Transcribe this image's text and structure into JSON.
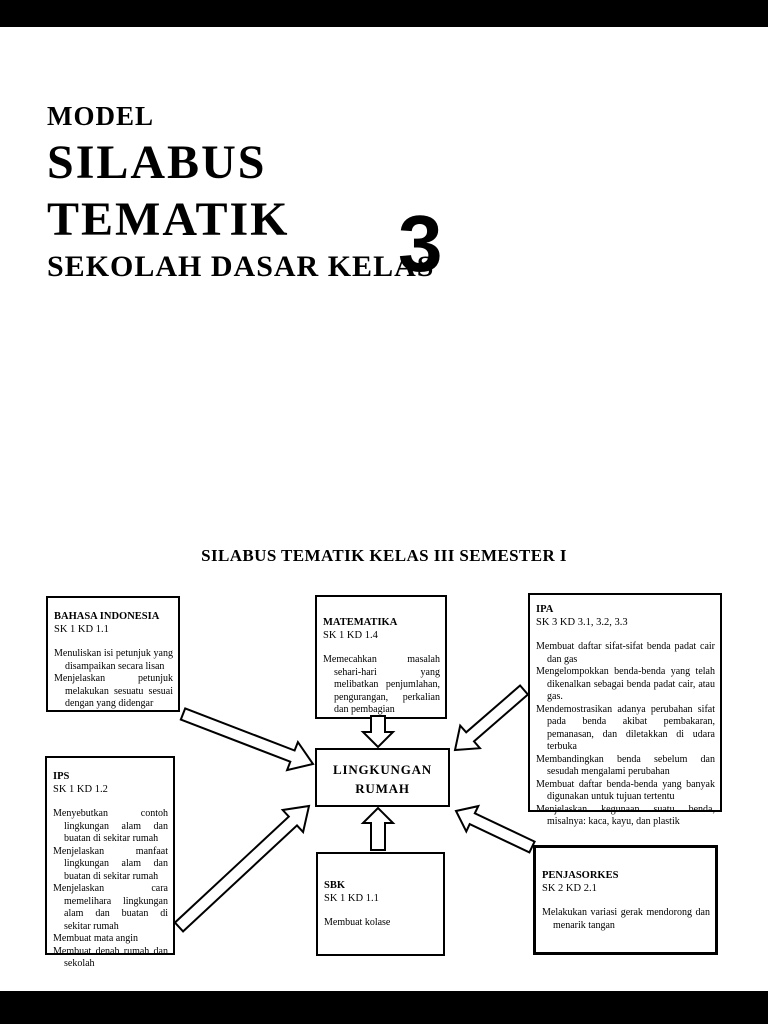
{
  "header": {
    "line1": "MODEL",
    "line2": "SILABUS",
    "line3": "TEMATIK",
    "line4": "SEKOLAH DASAR KELAS",
    "class_number": "3"
  },
  "diagram": {
    "heading": "SILABUS TEMATIK KELAS III SEMESTER I",
    "center": {
      "line1": "LINGKUNGAN",
      "line2": "RUMAH"
    },
    "boxes": [
      {
        "subject": "BAHASA INDONESIA",
        "code": "SK 1 KD 1.1",
        "items": [
          "Menuliskan isi petunjuk yang disampaikan secara lisan",
          "Menjelaskan petunjuk melakukan sesuatu sesuai dengan yang didengar"
        ]
      },
      {
        "subject": "MATEMATIKA",
        "code": "SK 1 KD 1.4",
        "items": [
          "Memecahkan masalah sehari-hari yang melibatkan penjumlahan, pengurangan, perkalian dan pembagian"
        ]
      },
      {
        "subject": "IPA",
        "code": "SK 3 KD 3.1, 3.2, 3.3",
        "items": [
          "Membuat daftar sifat-sifat benda padat cair dan gas",
          "Mengelompokkan benda-benda yang telah dikenalkan sebagai benda padat cair, atau gas.",
          "Mendemostrasikan adanya perubahan sifat pada benda akibat pembakaran, pemanasan, dan diletakkan di udara terbuka",
          "Membandingkan benda sebelum dan sesudah mengalami perubahan",
          "Membuat daftar benda-benda yang banyak digunakan untuk tujuan tertentu",
          "Menjelaskan kegunaan suatu benda, misalnya: kaca, kayu, dan plastik"
        ]
      },
      {
        "subject": "IPS",
        "code": "SK 1 KD 1.2",
        "items": [
          "Menyebutkan contoh lingkungan alam dan buatan di sekitar rumah",
          "Menjelaskan manfaat lingkungan alam dan buatan di sekitar rumah",
          "Menjelaskan cara memelihara lingkungan alam dan buatan di sekitar rumah",
          "Membuat mata angin",
          "Membuat denah rumah dan sekolah"
        ]
      },
      {
        "subject": "SBK",
        "code": "SK 1 KD 1.1",
        "items": [
          "Membuat kolase"
        ]
      },
      {
        "subject": "PENJASORKES",
        "code": "SK 2 KD 2.1",
        "items": [
          "Melakukan variasi gerak mendorong dan menarik tangan"
        ]
      }
    ]
  },
  "colors": {
    "page_background": "#ffffff",
    "letterbox": "#000000",
    "ink": "#000000"
  }
}
